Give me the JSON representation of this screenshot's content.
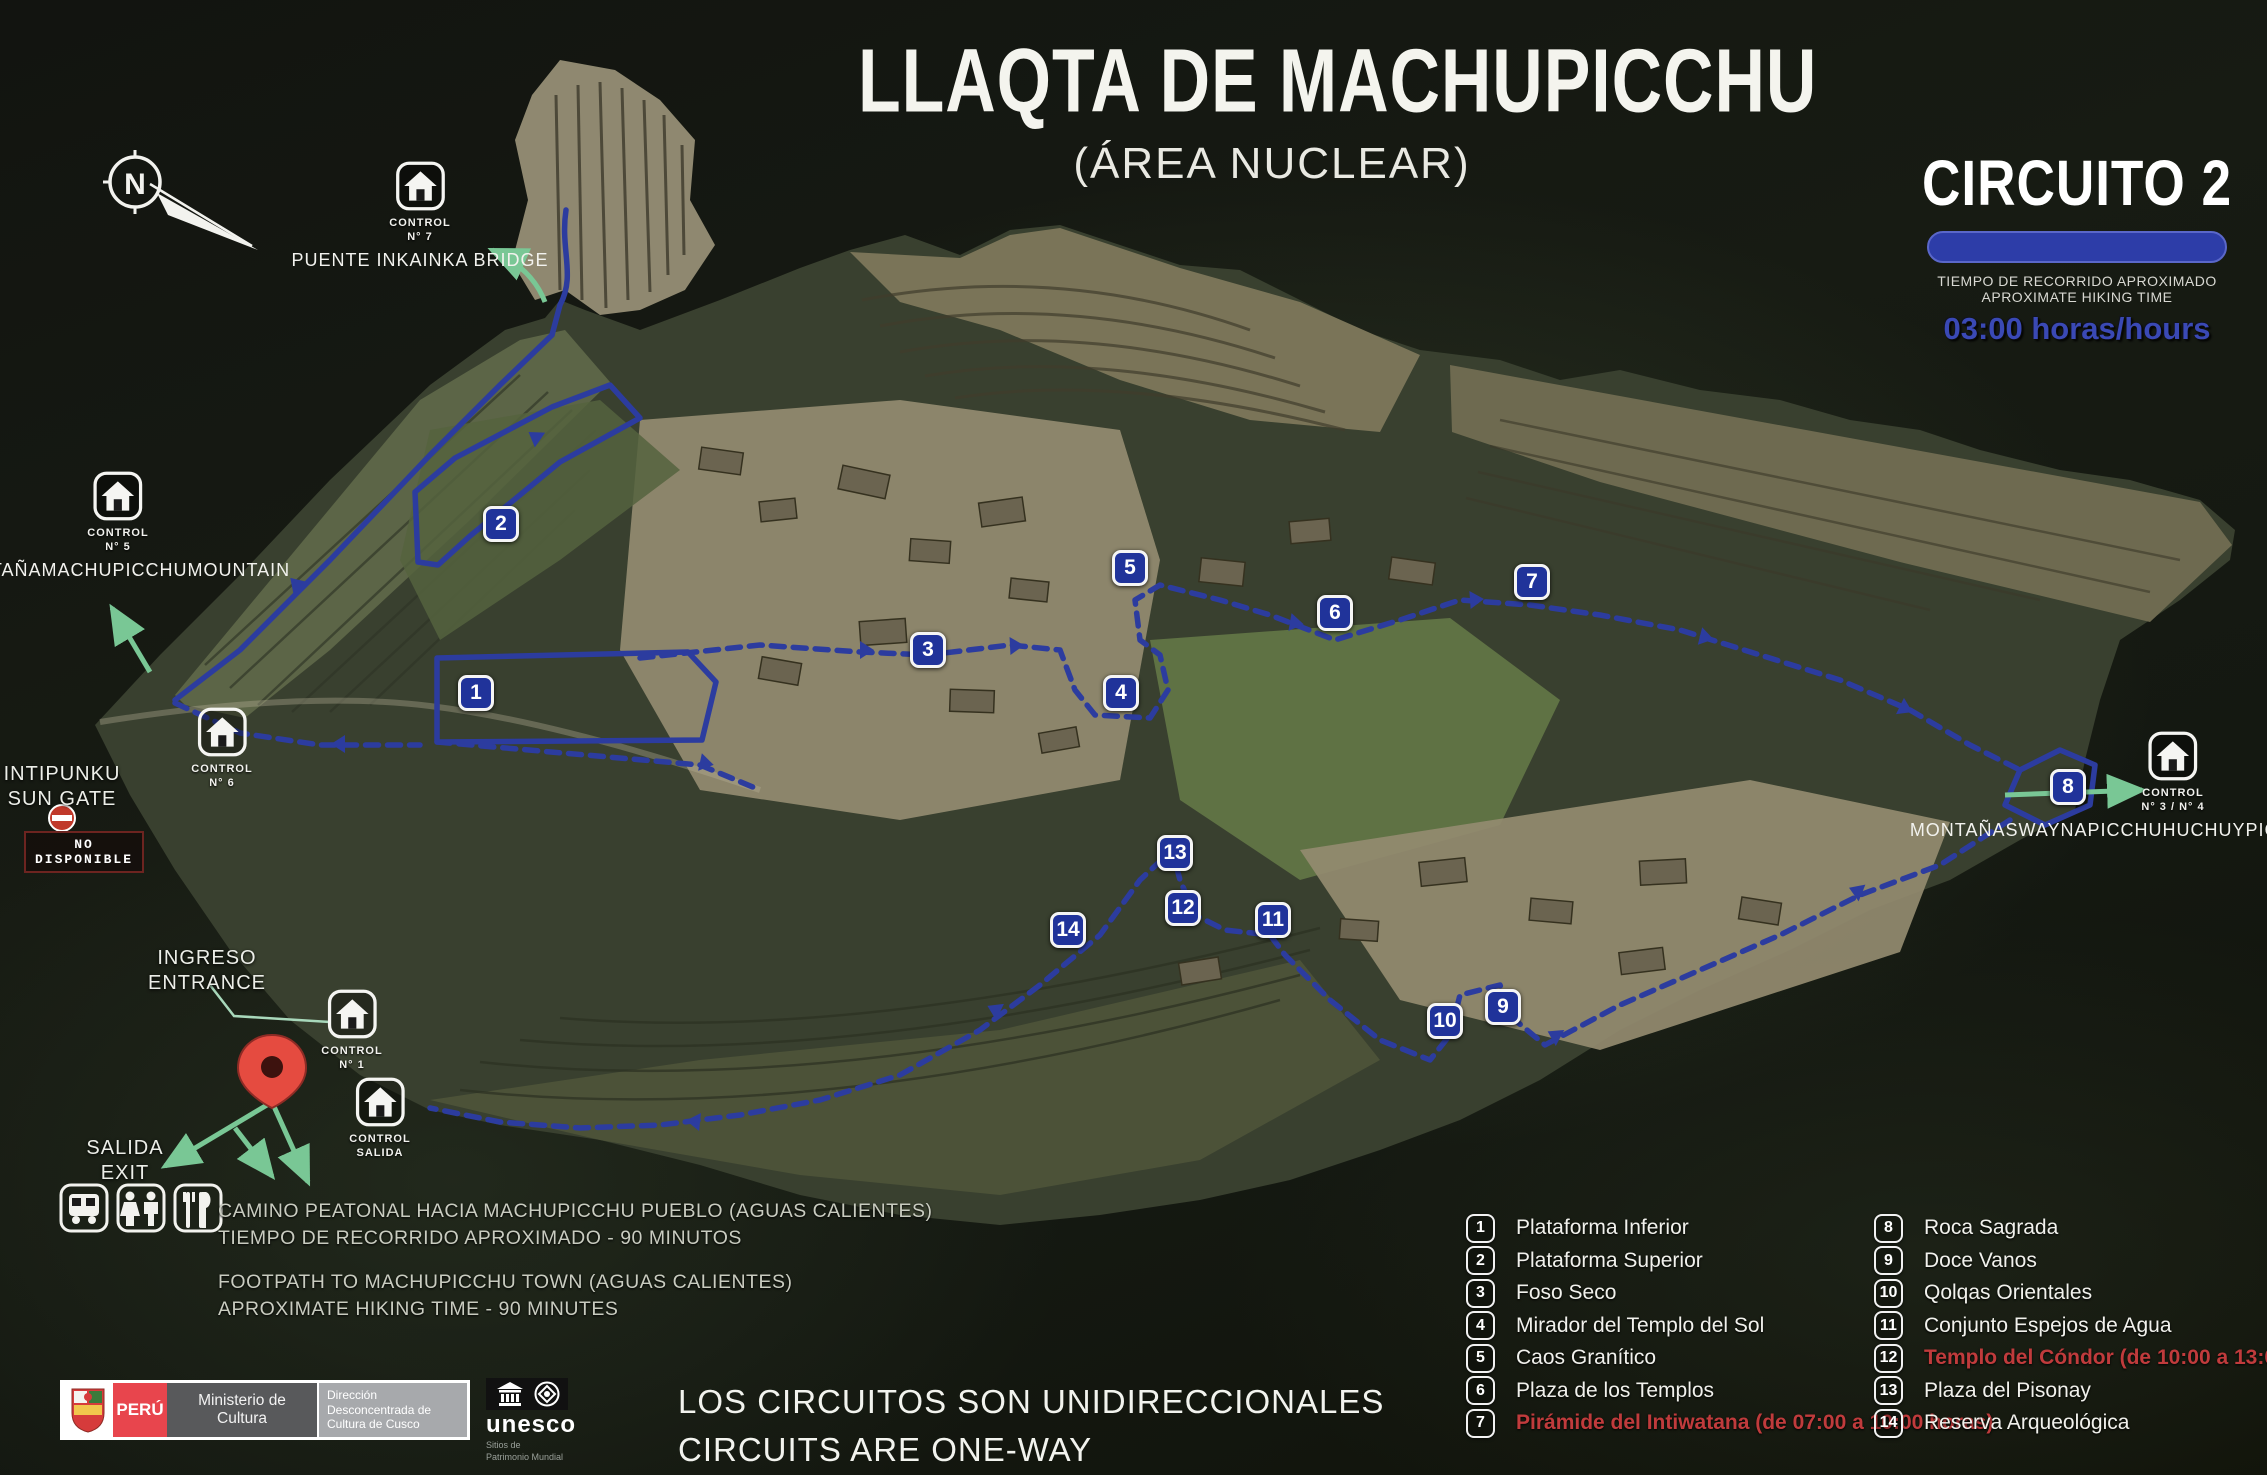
{
  "title": {
    "main": "LLAQTA DE MACHUPICCHU",
    "sub": "(ÁREA NUCLEAR)"
  },
  "circuit": {
    "name": "CIRCUITO 2",
    "time_label_es": "TIEMPO DE RECORRIDO APROXIMADO",
    "time_label_en": "APROXIMATE HIKING TIME",
    "time_value": "03:00 horas/hours"
  },
  "compass": {
    "label": "N"
  },
  "colors": {
    "route_blue": "#2c3c9f",
    "marker_blue": "#20339a",
    "circuit_bar_blue": "#2d3da8",
    "restricted_red": "#c03b3c",
    "arrow_green": "#79c795",
    "peru_red": "#e8454d"
  },
  "map": {
    "markers": [
      {
        "n": 1,
        "x": 476,
        "y": 693
      },
      {
        "n": 2,
        "x": 501,
        "y": 524
      },
      {
        "n": 3,
        "x": 928,
        "y": 650
      },
      {
        "n": 4,
        "x": 1121,
        "y": 693
      },
      {
        "n": 5,
        "x": 1130,
        "y": 568
      },
      {
        "n": 6,
        "x": 1335,
        "y": 613
      },
      {
        "n": 7,
        "x": 1532,
        "y": 582
      },
      {
        "n": 8,
        "x": 2068,
        "y": 787
      },
      {
        "n": 9,
        "x": 1503,
        "y": 1007
      },
      {
        "n": 10,
        "x": 1445,
        "y": 1021
      },
      {
        "n": 11,
        "x": 1273,
        "y": 920
      },
      {
        "n": 12,
        "x": 1183,
        "y": 908
      },
      {
        "n": 13,
        "x": 1175,
        "y": 853
      },
      {
        "n": 14,
        "x": 1068,
        "y": 930
      }
    ],
    "controls": [
      {
        "id": "control-7",
        "line1": "CONTROL",
        "line2": "N° 7",
        "x": 420,
        "y": 160,
        "caption": [
          "PUENTE INKA",
          "INKA BRIDGE"
        ]
      },
      {
        "id": "control-5",
        "line1": "CONTROL",
        "line2": "N° 5",
        "x": 118,
        "y": 470,
        "caption": [
          "MONTAÑA",
          "MACHUPICCHU",
          "MOUNTAIN"
        ]
      },
      {
        "id": "control-6",
        "line1": "CONTROL",
        "line2": "N° 6",
        "x": 222,
        "y": 706,
        "caption": []
      },
      {
        "id": "control-1",
        "line1": "CONTROL",
        "line2": "N° 1",
        "x": 352,
        "y": 988,
        "caption": []
      },
      {
        "id": "control-salida",
        "line1": "CONTROL",
        "line2": "SALIDA",
        "x": 380,
        "y": 1076,
        "caption": []
      },
      {
        "id": "control-3-4",
        "line1": "CONTROL",
        "line2": "N° 3 / N° 4",
        "x": 2173,
        "y": 730,
        "caption": [
          "MONTAÑAS",
          "WAYNAPICCHU",
          "HUCHUYPICCHU",
          "MOUNTAINS"
        ]
      }
    ],
    "labels": {
      "intipunku": [
        "INTIPUNKU",
        "SUN GATE"
      ],
      "ingreso": [
        "INGRESO",
        "ENTRANCE"
      ],
      "salida": [
        "SALIDA",
        "EXIT"
      ]
    },
    "no_disponible": "NO DISPONIBLE"
  },
  "legend": {
    "left": [
      {
        "n": 1,
        "label": "Plataforma Inferior",
        "highlight": false
      },
      {
        "n": 2,
        "label": "Plataforma Superior",
        "highlight": false
      },
      {
        "n": 3,
        "label": "Foso Seco",
        "highlight": false
      },
      {
        "n": 4,
        "label": "Mirador del Templo del Sol",
        "highlight": false
      },
      {
        "n": 5,
        "label": "Caos Granítico",
        "highlight": false
      },
      {
        "n": 6,
        "label": "Plaza de los Templos",
        "highlight": false
      },
      {
        "n": 7,
        "label": "Pirámide del Intiwatana (de 07:00 a 10:00 horas)",
        "highlight": true
      }
    ],
    "right": [
      {
        "n": 8,
        "label": "Roca Sagrada",
        "highlight": false
      },
      {
        "n": 9,
        "label": "Doce Vanos",
        "highlight": false
      },
      {
        "n": 10,
        "label": "Qolqas Orientales",
        "highlight": false
      },
      {
        "n": 11,
        "label": "Conjunto Espejos de Agua",
        "highlight": false
      },
      {
        "n": 12,
        "label": "Templo del Cóndor (de 10:00 a 13:00 horas)",
        "highlight": true
      },
      {
        "n": 13,
        "label": "Plaza del Pisonay",
        "highlight": false
      },
      {
        "n": 14,
        "label": "Reserva Arqueológica",
        "highlight": false
      }
    ]
  },
  "notes": {
    "footpath": [
      "CAMINO PEATONAL HACIA MACHUPICCHU PUEBLO (AGUAS CALIENTES)",
      "TIEMPO DE RECORRIDO APROXIMADO - 90 MINUTOS",
      "FOOTPATH TO MACHUPICCHU TOWN (AGUAS CALIENTES)",
      "APROXIMATE HIKING TIME - 90 MINUTES"
    ],
    "oneway": [
      "LOS CIRCUITOS SON UNIDIRECCIONALES",
      "CIRCUITS ARE ONE-WAY"
    ]
  },
  "footer": {
    "peru": "PERÚ",
    "ministerio": "Ministerio de Cultura",
    "direccion": "Dirección Desconcentrada de Cultura de Cusco",
    "unesco": "unesco",
    "unesco_sub1": "Sitios de",
    "unesco_sub2": "Patrimonio Mundial"
  }
}
